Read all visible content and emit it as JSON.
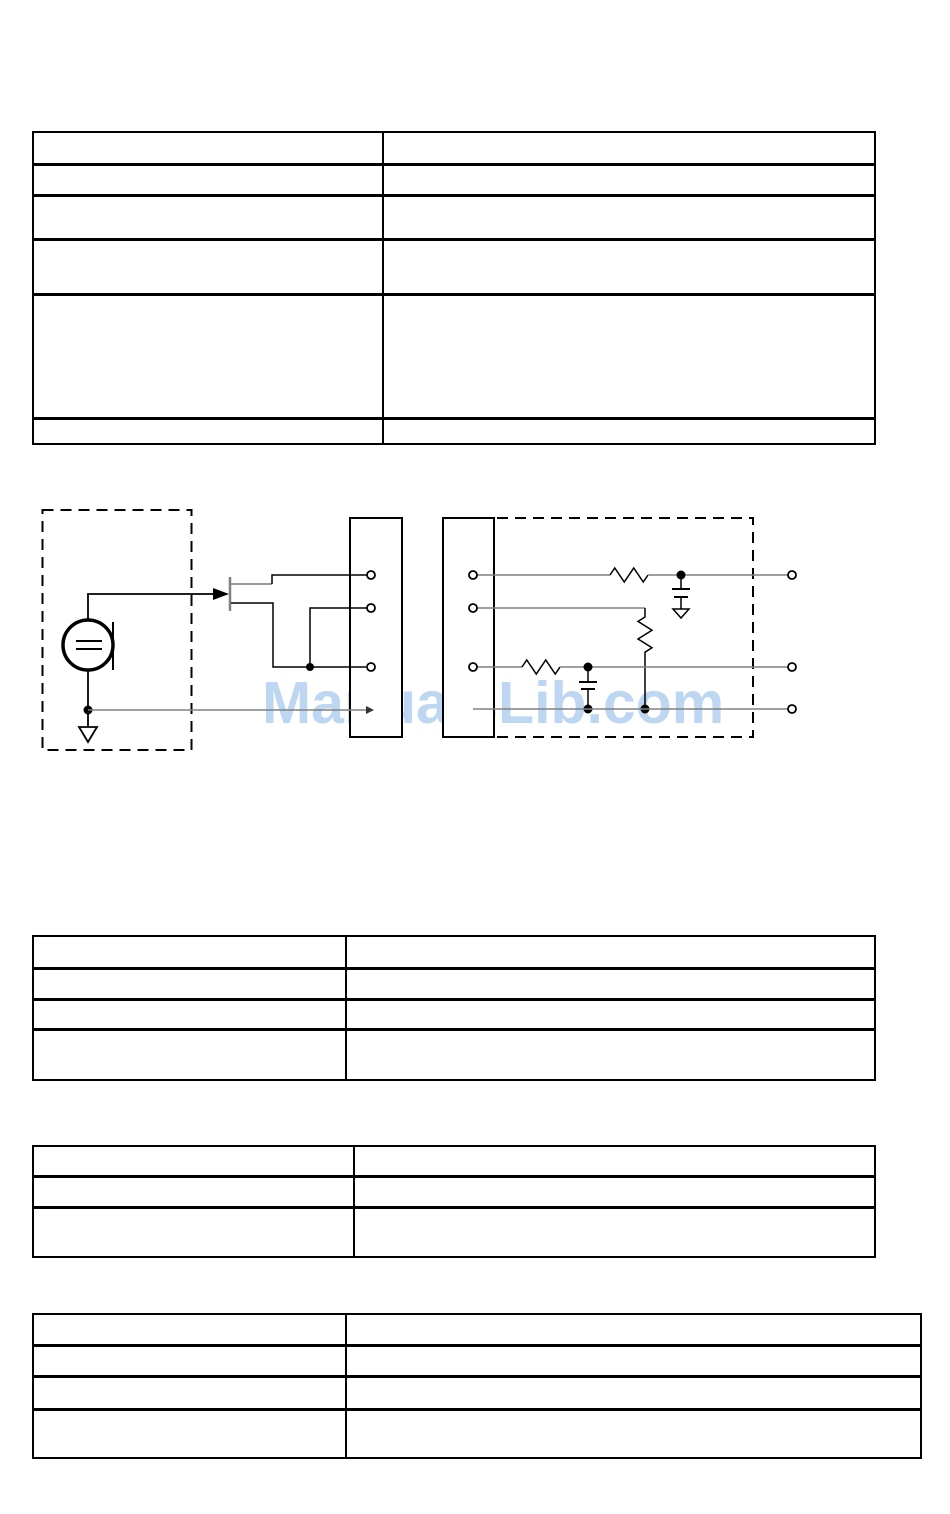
{
  "page": {
    "background": "#ffffff"
  },
  "watermark": {
    "text": "ManualsLib.com",
    "color": "#bdd6f2"
  },
  "diagram": {
    "type": "circuit-schematic",
    "description": "Electret microphone capsule with JFET impedance converter wired to a 3-terminal connector, feeding an RC bias/filter network (two series resistors with decoupling capacitors, one shunt resistor) inside a dashed enclosure with three output terminals",
    "wire_color": "#808080",
    "component_color": "#000000"
  },
  "tables": [
    {
      "id": "table-1",
      "rows": 6,
      "columns": 2,
      "content": ""
    },
    {
      "id": "table-2",
      "rows": 4,
      "columns": 2,
      "content": ""
    },
    {
      "id": "table-3",
      "rows": 3,
      "columns": 2,
      "content": ""
    },
    {
      "id": "table-4",
      "rows": 4,
      "columns": 2,
      "content": ""
    }
  ]
}
